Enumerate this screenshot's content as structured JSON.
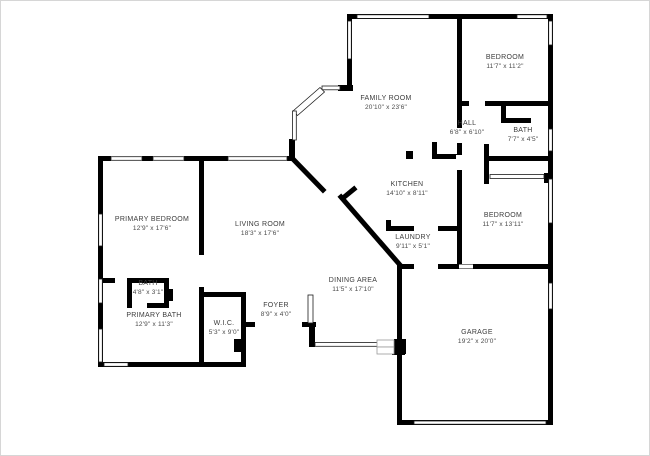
{
  "canvas": {
    "background_color": "#ffffff",
    "wall_color": "#000000",
    "text_color": "#3c3c3c",
    "frame_color": "#d6d6d6"
  },
  "floor_plan": {
    "rooms": [
      {
        "id": "family-room",
        "name": "FAMILY ROOM",
        "dimensions": "20'10\" x 23'6\"",
        "cx": 385,
        "cy": 99
      },
      {
        "id": "bedroom-top-right",
        "name": "BEDROOM",
        "dimensions": "11'7\" x 11'2\"",
        "cx": 504,
        "cy": 58
      },
      {
        "id": "hall",
        "name": "HALL",
        "dimensions": "6'8\" x 6'10\"",
        "cx": 466,
        "cy": 124
      },
      {
        "id": "bath-right",
        "name": "BATH",
        "dimensions": "7'7\" x 4'5\"",
        "cx": 522,
        "cy": 131
      },
      {
        "id": "kitchen",
        "name": "KITCHEN",
        "dimensions": "14'10\" x 8'11\"",
        "cx": 406,
        "cy": 185
      },
      {
        "id": "bedroom-mid-right",
        "name": "BEDROOM",
        "dimensions": "11'7\" x 13'11\"",
        "cx": 502,
        "cy": 216
      },
      {
        "id": "laundry",
        "name": "LAUNDRY",
        "dimensions": "9'11\" x 5'1\"",
        "cx": 412,
        "cy": 238
      },
      {
        "id": "primary-bedroom",
        "name": "PRIMARY BEDROOM",
        "dimensions": "12'9\" x 17'6\"",
        "cx": 151,
        "cy": 220
      },
      {
        "id": "living-room",
        "name": "LIVING ROOM",
        "dimensions": "18'3\" x 17'6\"",
        "cx": 259,
        "cy": 225
      },
      {
        "id": "bath-small",
        "name": "BATH",
        "dimensions": "4'8\" x 3'1\"",
        "cx": 147,
        "cy": 284
      },
      {
        "id": "primary-bath",
        "name": "PRIMARY BATH",
        "dimensions": "12'9\" x 11'3\"",
        "cx": 153,
        "cy": 316
      },
      {
        "id": "wic",
        "name": "W.I.C.",
        "dimensions": "5'3\" x 9'0\"",
        "cx": 223,
        "cy": 324
      },
      {
        "id": "foyer",
        "name": "FOYER",
        "dimensions": "8'9\" x 4'0\"",
        "cx": 275,
        "cy": 306
      },
      {
        "id": "dining-area",
        "name": "DINING AREA",
        "dimensions": "11'5\" x 17'10\"",
        "cx": 352,
        "cy": 281
      },
      {
        "id": "garage",
        "name": "GARAGE",
        "dimensions": "19'2\" x 20'0\"",
        "cx": 476,
        "cy": 333
      }
    ]
  }
}
